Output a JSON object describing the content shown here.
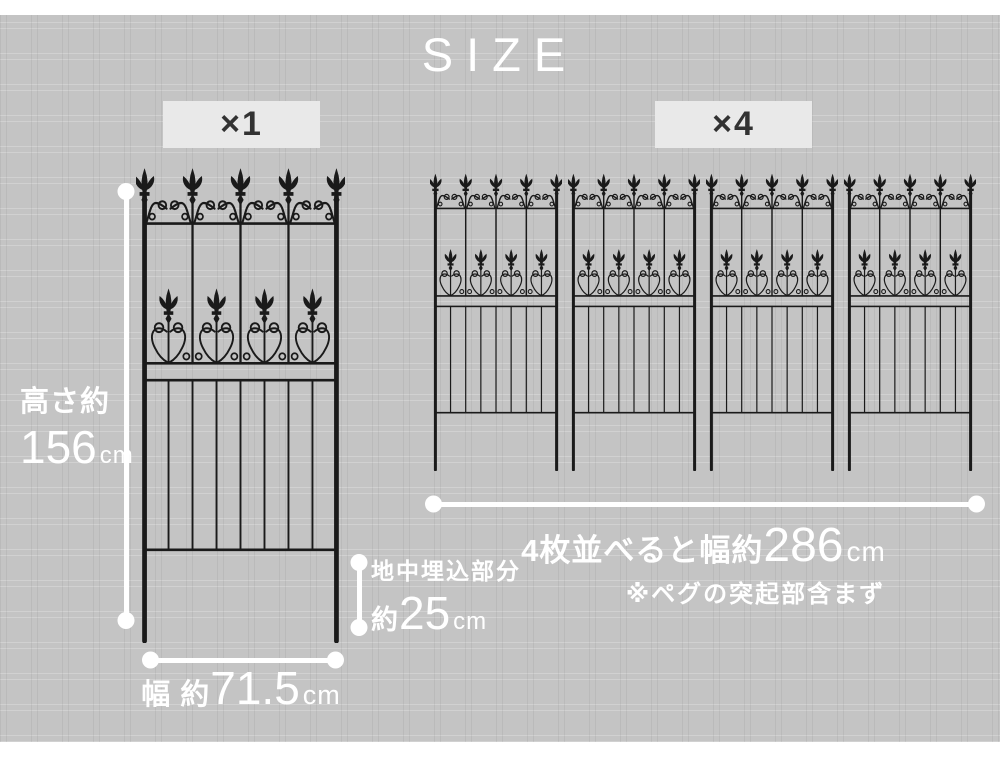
{
  "title": "SIZE",
  "single_section": {
    "badge_label": "×1",
    "height": {
      "label": "高さ約",
      "value": "156",
      "unit": "cm"
    },
    "width": {
      "label": "幅 約",
      "value": "71.5",
      "unit": "cm"
    },
    "buried": {
      "label": "地中埋込部分",
      "prefix": "約",
      "value": "25",
      "unit": "cm"
    }
  },
  "multi_section": {
    "badge_label": "×4",
    "panel_count": 4,
    "total_width": {
      "label": "4枚並べると幅約",
      "value": "286",
      "unit": "cm"
    },
    "note": "※ペグの突起部含まず"
  },
  "colors": {
    "background": "#c4c4c4",
    "strip": "#ffffff",
    "badge_background": "#e9e9e9",
    "badge_text": "#323232",
    "title_text": "#ffffff",
    "dimension": "#ffffff",
    "fence": "#1a1a1a"
  }
}
